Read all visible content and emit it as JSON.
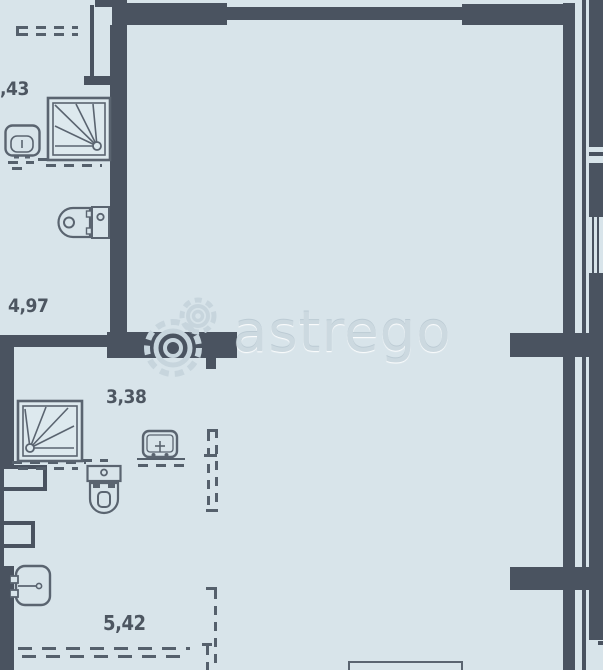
{
  "title": "apartment-floor-plan",
  "watermark": {
    "text": "astrego",
    "logo": "gears-icon"
  },
  "rooms": [
    {
      "name": "niche-top-left",
      "area": ",43"
    },
    {
      "name": "bathroom-upper",
      "area": "4,97"
    },
    {
      "name": "bathroom-lower",
      "area": "3,38"
    },
    {
      "name": "hallway-lower",
      "area": "5,42"
    }
  ],
  "fixtures": [
    "shower-tray-upper",
    "washbasin-upper",
    "toilet-upper",
    "shower-tray-lower",
    "toilet-lower",
    "washbasin-lower",
    "sink-hallway",
    "furniture-bottom"
  ],
  "colors": {
    "background": "#d8e4ea",
    "walls": "#4a5360",
    "fixture_lines": "#5a6470",
    "label_text": "#4d5661",
    "watermark": "#c9d6de"
  }
}
